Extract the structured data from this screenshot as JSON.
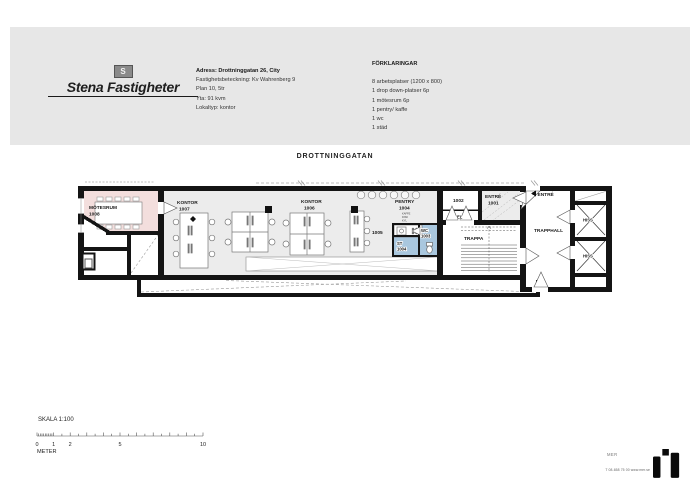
{
  "header": {
    "brand": "Stena Fastigheter",
    "flag_initial": "S",
    "property": {
      "line1": "Adress: Drottninggatan 26, City",
      "line2": "Fastighetsbeteckning: Kv Wahrenberg 9",
      "line3": "Plan 10, 5tr",
      "line4": "Yta: 91 kvm",
      "line5": "Lokaltyp: kontor"
    },
    "legend": {
      "title": "FÖRKLARINGAR",
      "items": [
        "8 arbetsplatser (1200 x 800)",
        "1 drop down-platser 6p",
        "1 mötesrum 6p",
        "1 pentry/ kaffe",
        "1 wc",
        "1 städ"
      ]
    }
  },
  "plan": {
    "street_label": "DROTTNINGGATAN",
    "rooms": {
      "motesrum": {
        "name": "MÖTESRUM",
        "number": "1008"
      },
      "kontor_1007": {
        "name": "KONTOR",
        "number": "1007"
      },
      "kontor_1006": {
        "name": "KONTOR",
        "number": "1006"
      },
      "open_1005": {
        "number": "1005"
      },
      "pentry": {
        "name": "PENTRY",
        "number": "1004",
        "appliances": [
          "KAFFE",
          "DISK",
          "KYL"
        ]
      },
      "st": {
        "name": "ST",
        "number": "1004"
      },
      "wc": {
        "name": "WC",
        "number": "1003"
      },
      "el_room": {
        "number": "1002",
        "name": "EL"
      },
      "entre": {
        "name": "ENTRÉ",
        "number": "1001"
      },
      "trappa": {
        "name": "TRAPPA"
      },
      "trapphall": {
        "name": "TRAPPHALL"
      },
      "entre_arrow": "ENTRÉ",
      "hiss": {
        "name": "HISS"
      }
    },
    "colors": {
      "meeting_room": "#f3dedd",
      "wet_room": "#a9c7de",
      "office_floor": "#ececec",
      "wall": "#141414"
    }
  },
  "scale": {
    "label": "SKALA 1:100",
    "ticks": [
      "0",
      "1",
      "2",
      "5",
      "10"
    ],
    "unit": "METER"
  },
  "footer": {
    "brand_small": "MER",
    "contact": "T 08-658 75 00  www.mer.se"
  }
}
